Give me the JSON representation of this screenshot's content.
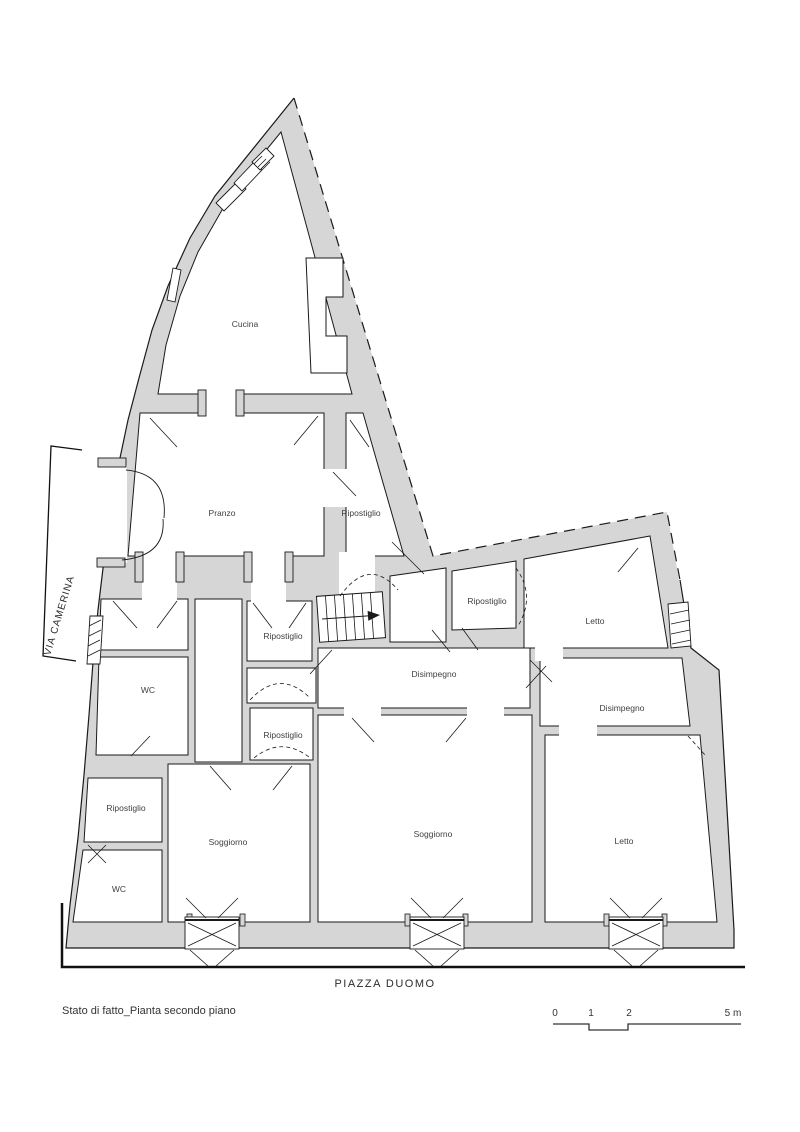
{
  "title": "Stato di fatto_Pianta secondo piano",
  "streets": {
    "bottom": "PIAZZA DUOMO",
    "left": "VIA CAMERINA"
  },
  "rooms": [
    {
      "id": "cucina",
      "label": "Cucina"
    },
    {
      "id": "pranzo",
      "label": "Pranzo"
    },
    {
      "id": "ripostiglio-pranzo",
      "label": "Ripostiglio"
    },
    {
      "id": "ripostiglio-nord",
      "label": "Ripostiglio"
    },
    {
      "id": "letto-nord",
      "label": "Letto"
    },
    {
      "id": "ripostiglio-centro-nord",
      "label": "Ripostiglio"
    },
    {
      "id": "disimpegno-centro",
      "label": "Disimpegno"
    },
    {
      "id": "wc-nord",
      "label": "WC"
    },
    {
      "id": "disimpegno-est",
      "label": "Disimpegno"
    },
    {
      "id": "ripostiglio-centro-sud",
      "label": "Ripostiglio"
    },
    {
      "id": "ripostiglio-ovest",
      "label": "Ripostiglio"
    },
    {
      "id": "soggiorno-ovest",
      "label": "Soggiorno"
    },
    {
      "id": "soggiorno-centro",
      "label": "Soggiorno"
    },
    {
      "id": "letto-sud",
      "label": "Letto"
    },
    {
      "id": "wc-sud",
      "label": "WC"
    }
  ],
  "scale_bar": {
    "t0": "0",
    "t1": "1",
    "t2": "2",
    "t5": "5 m"
  },
  "colors": {
    "wall_fill": "#d6d6d6",
    "line": "#1a1a1a",
    "text": "#3f3f3f"
  }
}
